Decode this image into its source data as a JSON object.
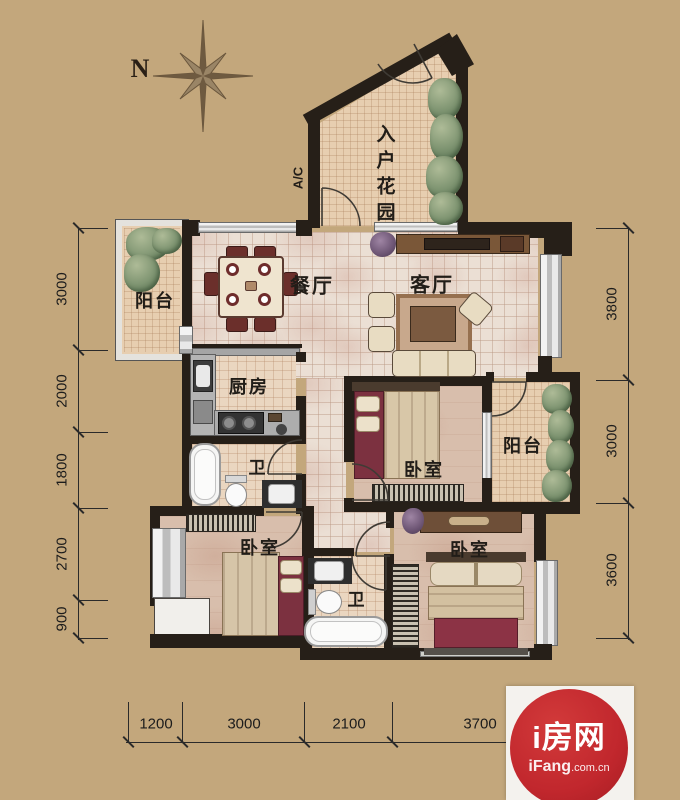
{
  "compass": {
    "north": "N"
  },
  "labels": {
    "entry_garden": "入户花园",
    "ac": "A/C",
    "dining": "餐厅",
    "living": "客厅",
    "kitchen": "厨房",
    "bath_upper": "卫",
    "bath_lower": "卫",
    "bedroom_mid": "卧室",
    "bedroom_left": "卧室",
    "bedroom_right": "卧室",
    "balcony_left": "阳台",
    "balcony_right": "阳台"
  },
  "dimensions": {
    "left": [
      "3000",
      "2000",
      "1800",
      "2700",
      "900"
    ],
    "right": [
      "3800",
      "3000",
      "3600"
    ],
    "bottom": [
      "1200",
      "3000",
      "2100",
      "3700"
    ]
  },
  "watermark": {
    "brand": "i房网",
    "site_bold": "iFang",
    "site_suffix": ".com.cn",
    "logo_red": "#c1272d"
  },
  "colors": {
    "background_tan": "#c3a77c",
    "wall_dark": "#261f18",
    "logo_red": "#c1272d"
  }
}
